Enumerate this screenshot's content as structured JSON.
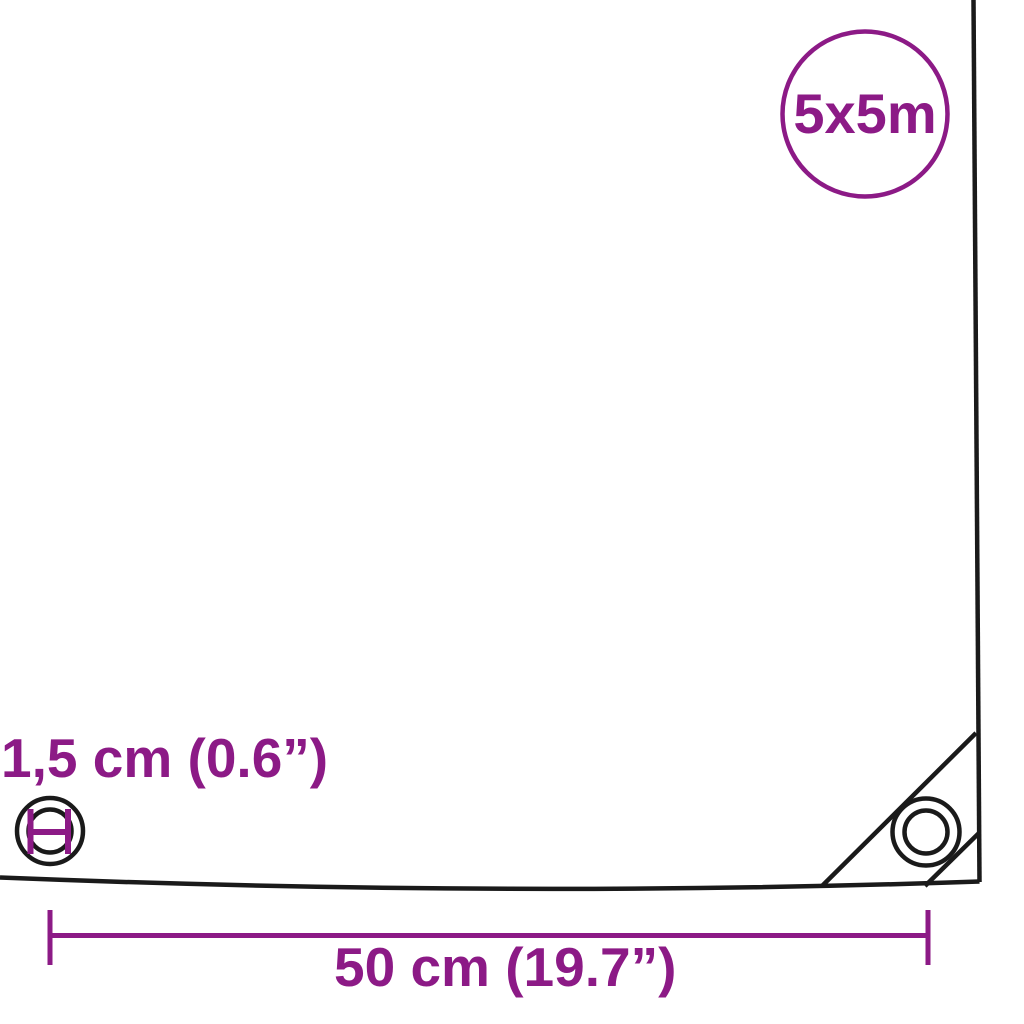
{
  "diagram": {
    "size_badge": {
      "label": "5x5m"
    },
    "eyelet_detail": {
      "diameter_label": "1,5 cm (0.6”)"
    },
    "eyelet_spacing": {
      "label": "50 cm (19.7”)"
    }
  },
  "colors": {
    "accent": "#8C1A86",
    "line": "#1A1A1A",
    "background": "#FFFFFF"
  }
}
